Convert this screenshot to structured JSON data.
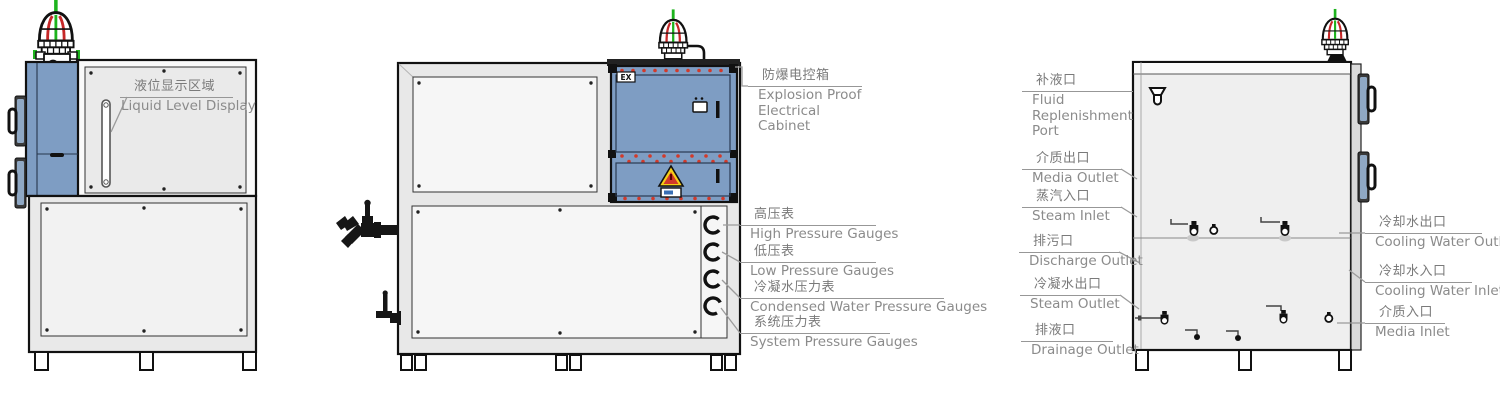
{
  "diagram": {
    "title_hint": "explosion-proof temperature control unit three-view technical diagram",
    "colors": {
      "cabinet_blue": "#7E9DC3",
      "panel_gray": "#EFEFEF",
      "outline": "#1A1A1A",
      "label_text": "#7A7A7A",
      "bolt_red": "#D23A2A",
      "beacon_green": "#1DB31D",
      "beacon_red": "#C62828",
      "warning_yellow": "#F6CF17"
    },
    "left_view": {
      "callouts": [
        {
          "id": "liquid-level-display",
          "zh": "液位显示区域",
          "en": "Liquid Level Display"
        }
      ]
    },
    "front_view": {
      "ex_marking": "EX",
      "callouts": [
        {
          "id": "explosion-proof-electrical-cabinet",
          "zh": "防爆电控箱",
          "en": "Explosion Proof Electrical Cabinet"
        },
        {
          "id": "high-pressure-gauges",
          "zh": "高压表",
          "en": "High Pressure Gauges"
        },
        {
          "id": "low-pressure-gauges",
          "zh": "低压表",
          "en": "Low Pressure Gauges"
        },
        {
          "id": "condensed-water-pressure-gauges",
          "zh": "冷凝水压力表",
          "en": "Condensed Water Pressure Gauges"
        },
        {
          "id": "system-pressure-gauges",
          "zh": "系统压力表",
          "en": "System Pressure Gauges"
        }
      ]
    },
    "right_view": {
      "left_callouts": [
        {
          "id": "fluid-replenishment-port",
          "zh": "补液口",
          "en": "Fluid Replenishment Port"
        },
        {
          "id": "media-outlet",
          "zh": "介质出口",
          "en": "Media Outlet"
        },
        {
          "id": "steam-inlet",
          "zh": "蒸汽入口",
          "en": "Steam Inlet"
        },
        {
          "id": "discharge-outlet",
          "zh": "排污口",
          "en": "Discharge Outlet"
        },
        {
          "id": "condensed-water-outlet",
          "zh": "冷凝水出口",
          "en": "Steam Outlet"
        },
        {
          "id": "drainage-outlet",
          "zh": "排液口",
          "en": "Drainage Outlet"
        }
      ],
      "right_callouts": [
        {
          "id": "cooling-water-outlet",
          "zh": "冷却水出口",
          "en": "Cooling Water Outlet"
        },
        {
          "id": "cooling-water-inlet",
          "zh": "冷却水入口",
          "en": "Cooling Water Inlet"
        },
        {
          "id": "media-inlet",
          "zh": "介质入口",
          "en": "Media Inlet"
        }
      ]
    }
  }
}
